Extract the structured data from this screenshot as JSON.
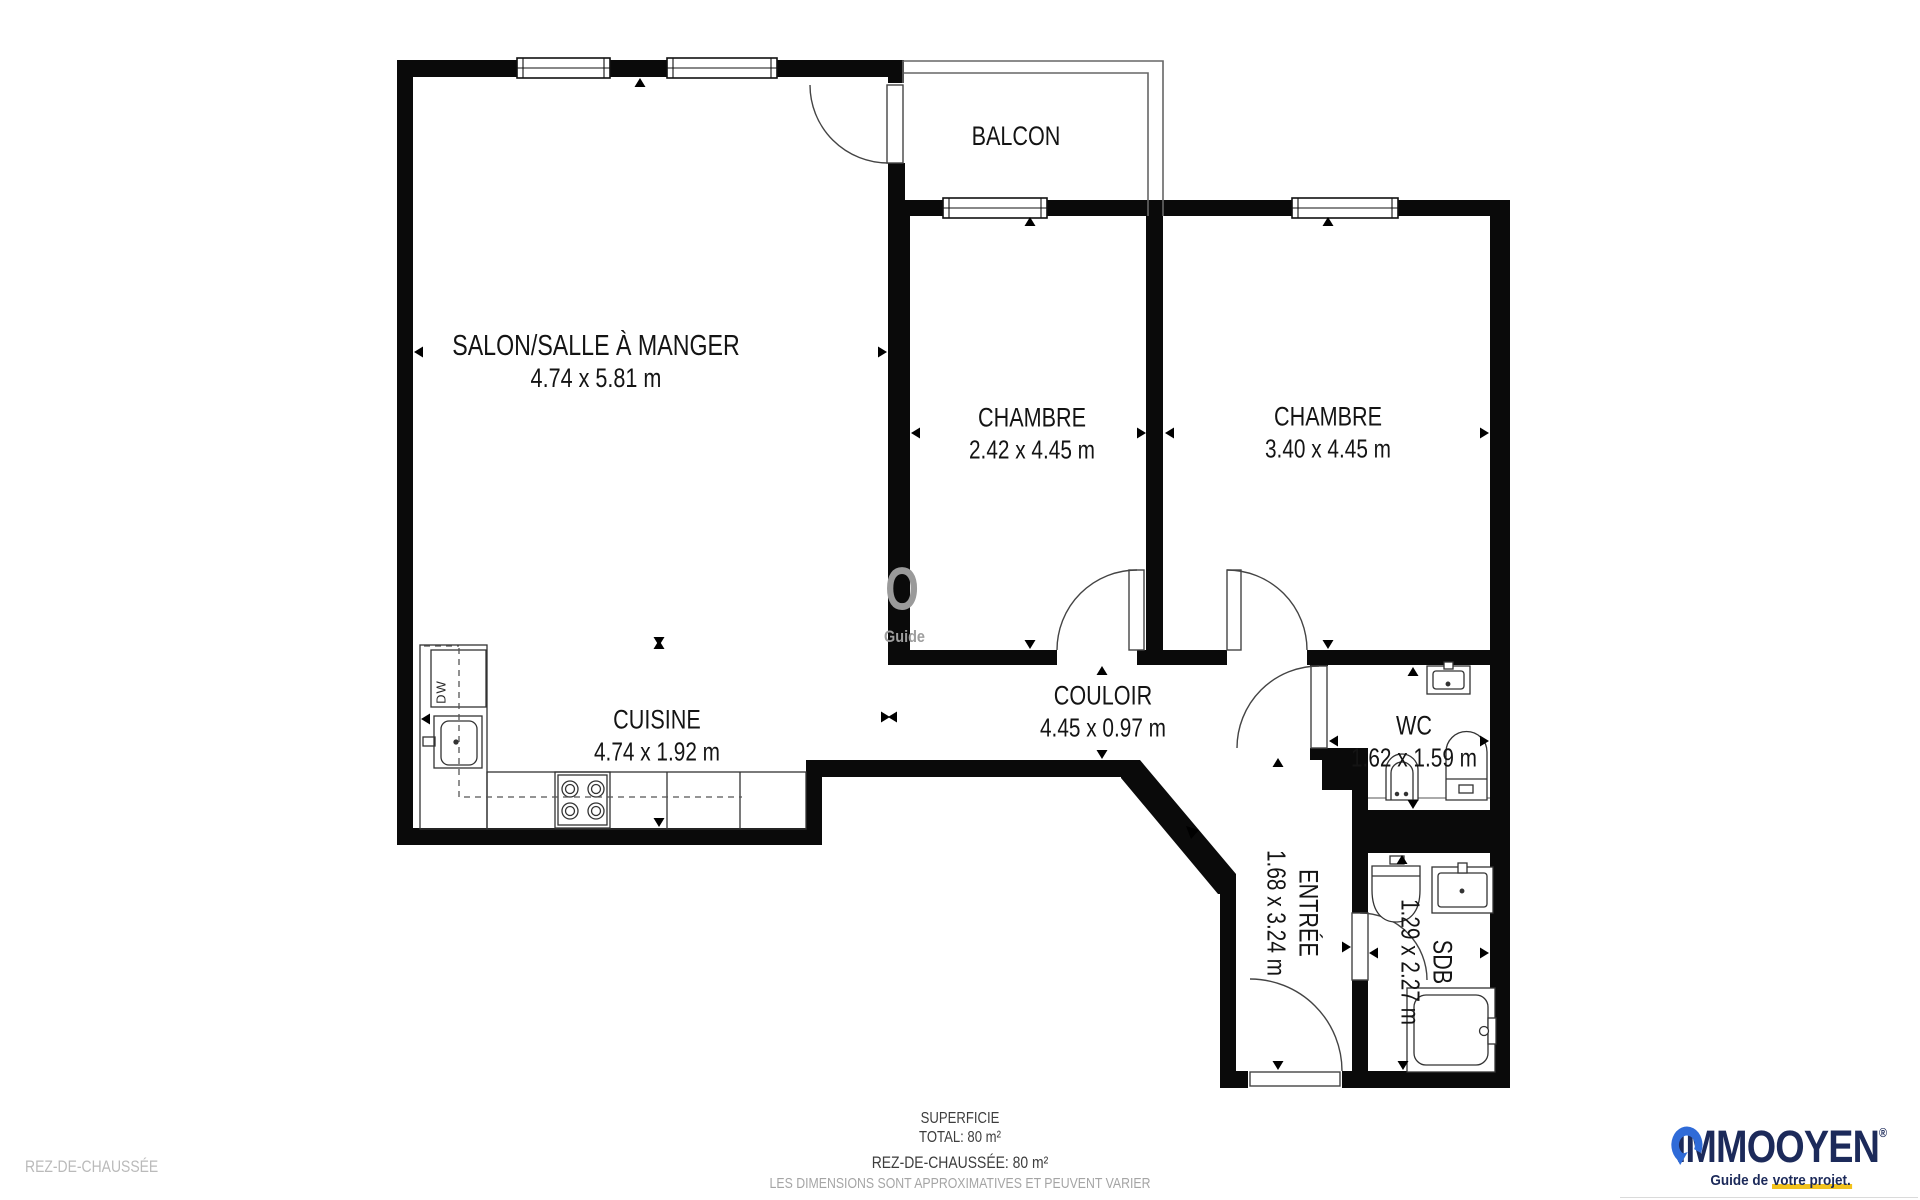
{
  "plan": {
    "floor_name": "REZ-DE-CHAUSSÉE",
    "rooms": {
      "salon": {
        "name": "SALON/SALLE À MANGER",
        "dims": "4.74 x 5.81 m"
      },
      "balcon": {
        "name": "BALCON"
      },
      "chambre1": {
        "name": "CHAMBRE",
        "dims": "2.42 x 4.45 m"
      },
      "chambre2": {
        "name": "CHAMBRE",
        "dims": "3.40 x 4.45 m"
      },
      "cuisine": {
        "name": "CUISINE",
        "dims": "4.74 x 1.92 m"
      },
      "couloir": {
        "name": "COULOIR",
        "dims": "4.45 x 0.97 m"
      },
      "wc": {
        "name": "WC",
        "dims": "1.62 x 1.59 m"
      },
      "entree": {
        "name": "ENTRÉE",
        "dims": "1.68 x 3.24 m"
      },
      "sdb": {
        "name": "SDB",
        "dims": "1.29 x 2.27 m"
      }
    },
    "appliance_labels": {
      "dishwasher": "DW"
    },
    "watermark": {
      "letter": "O",
      "word": "Guide"
    }
  },
  "summary": {
    "title": "SUPERFICIE",
    "total": "TOTAL: 80 m²",
    "floor_total": "REZ-DE-CHAUSSÉE: 80 m²",
    "disclaimer": "LES DIMENSIONS SONT APPROXIMATIVES ET PEUVENT VARIER"
  },
  "footer": {
    "floor_label": "REZ-DE-CHAUSSÉE"
  },
  "logo": {
    "prefix": "IMMO",
    "suffix": "OYEN",
    "registered": "®",
    "tagline_prefix": "Guide de ",
    "tagline_highlight": "votre projet.",
    "navy": "#1c2a5a",
    "blue": "#2f6bd8",
    "yellow": "#f2c21d"
  }
}
